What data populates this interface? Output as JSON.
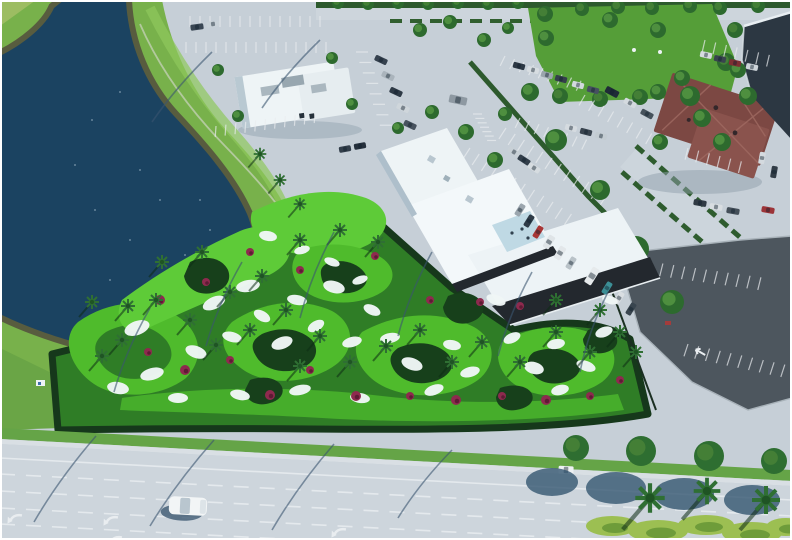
{
  "meta": {
    "title": "aerial-photo-mini-golf-complex",
    "width": 792,
    "height": 540
  },
  "palette": {
    "pavement": "#c6cfd7",
    "road": "#cdd5dc",
    "sidewalk": "#d9dfe4",
    "dark_lot": "#4d565e",
    "lake": "#1b4361",
    "rock_shore": "#585c3f",
    "bank_grass": "#78b14b",
    "bank_light": "#8fc75d",
    "verge_grass": "#65a447",
    "golf_base": "#2f7d26",
    "golf_bright": "#4fbb2c",
    "golf_light": "#5ecb38",
    "shrub_dark": "#17401b",
    "bunker": "#f0f6f6",
    "roof_white": "#eef4f6",
    "wall_dark": "#23282e",
    "roof_red": "#7c4843",
    "roof_red_light": "#8a534d",
    "dark_building": "#2c3742",
    "hedge": "#2d5a2d",
    "tree": "#2e6e31",
    "shadow_blue": "#31536e",
    "line_white": "#e9edf0",
    "flower": "#8e2a4e",
    "patio_blue": "#bfd9e4",
    "field_grass": "#559e38"
  },
  "scene": {
    "regions": [
      "lake",
      "mini-golf-course",
      "clubhouse",
      "north-building",
      "red-roof-building",
      "parking-lots",
      "boulevard"
    ],
    "cars": [
      [
        197,
        27,
        13,
        6,
        -8,
        "#3a4754"
      ],
      [
        213,
        24,
        13,
        6,
        -8,
        "#c9d2d8"
      ],
      [
        381,
        60,
        13,
        6,
        25,
        "#35414e"
      ],
      [
        388,
        76,
        13,
        6,
        25,
        "#aab4bc"
      ],
      [
        396,
        92,
        13,
        6,
        25,
        "#2e3a46"
      ],
      [
        403,
        108,
        13,
        6,
        25,
        "#cfd6db"
      ],
      [
        410,
        125,
        13,
        6,
        25,
        "#47525e"
      ],
      [
        458,
        100,
        18,
        8,
        12,
        "#8e99a2"
      ],
      [
        345,
        149,
        12,
        6,
        -10,
        "#323e4a"
      ],
      [
        360,
        146,
        12,
        6,
        -10,
        "#25303c"
      ],
      [
        519,
        66,
        12,
        6,
        15,
        "#2c3844"
      ],
      [
        533,
        70,
        12,
        6,
        15,
        "#d7dde1"
      ],
      [
        547,
        75,
        12,
        6,
        15,
        "#9aa5ad"
      ],
      [
        561,
        79,
        12,
        6,
        15,
        "#343f4b"
      ],
      [
        578,
        85,
        12,
        6,
        15,
        "#d2d9de"
      ],
      [
        593,
        90,
        12,
        6,
        15,
        "#465160"
      ],
      [
        571,
        128,
        12,
        6,
        15,
        "#d5dbe0"
      ],
      [
        586,
        132,
        12,
        6,
        15,
        "#39444f"
      ],
      [
        601,
        136,
        12,
        6,
        15,
        "#c3ccd2"
      ],
      [
        514,
        152,
        13,
        6,
        33,
        "#c8d0d6"
      ],
      [
        524,
        160,
        13,
        6,
        33,
        "#323e4a"
      ],
      [
        534,
        168,
        13,
        6,
        33,
        "#d6dce0"
      ],
      [
        520,
        210,
        13,
        6,
        -58,
        "#9ba6ae"
      ],
      [
        529,
        221,
        13,
        6,
        -58,
        "#2f3b47"
      ],
      [
        538,
        232,
        13,
        6,
        -58,
        "#a83636"
      ],
      [
        549,
        242,
        14,
        7,
        -58,
        "#dfe4e7"
      ],
      [
        560,
        253,
        14,
        7,
        -58,
        "#e3e7ea"
      ],
      [
        571,
        263,
        13,
        6,
        -58,
        "#b9c2c8"
      ],
      [
        592,
        276,
        18,
        8,
        -58,
        "#e6eaec"
      ],
      [
        607,
        288,
        13,
        6,
        -58,
        "#3c8f96"
      ],
      [
        619,
        298,
        13,
        6,
        -58,
        "#d9dee2"
      ],
      [
        631,
        309,
        13,
        6,
        -58,
        "#39454f"
      ],
      [
        612,
        92,
        14,
        7,
        28,
        "#1f2b37"
      ],
      [
        630,
        103,
        13,
        6,
        28,
        "#d4dadf"
      ],
      [
        647,
        114,
        13,
        6,
        28,
        "#46525c"
      ],
      [
        706,
        55,
        12,
        6,
        12,
        "#d6dce0"
      ],
      [
        720,
        59,
        12,
        6,
        12,
        "#39444e"
      ],
      [
        735,
        63,
        12,
        6,
        12,
        "#7e2f33"
      ],
      [
        752,
        67,
        12,
        6,
        12,
        "#cdd4d9"
      ],
      [
        700,
        203,
        13,
        6,
        10,
        "#2f3a44"
      ],
      [
        716,
        207,
        13,
        6,
        10,
        "#d8dde1"
      ],
      [
        733,
        211,
        13,
        6,
        10,
        "#444f59"
      ],
      [
        768,
        210,
        13,
        6,
        10,
        "#9c3438"
      ],
      [
        762,
        158,
        12,
        6,
        100,
        "#d4dadf"
      ],
      [
        774,
        172,
        12,
        6,
        100,
        "#313c46"
      ],
      [
        566,
        470,
        15,
        8,
        3,
        "#eef1f3"
      ]
    ],
    "parking_rows": [
      [
        190,
        16,
        0,
        14,
        10,
        11,
        0
      ],
      [
        186,
        42,
        0,
        15,
        10,
        11,
        0
      ],
      [
        216,
        126,
        -8,
        11,
        10,
        11,
        12
      ],
      [
        368,
        52,
        72,
        8,
        11,
        12,
        18
      ],
      [
        505,
        56,
        18,
        9,
        10,
        11,
        8
      ],
      [
        520,
        118,
        18,
        8,
        10,
        11,
        8
      ],
      [
        470,
        148,
        33,
        12,
        11,
        13,
        0
      ],
      [
        506,
        128,
        33,
        12,
        11,
        13,
        0
      ],
      [
        585,
        95,
        30,
        8,
        11,
        12,
        0
      ],
      [
        688,
        148,
        14,
        6,
        11,
        12,
        0
      ],
      [
        705,
        40,
        13,
        7,
        11,
        12,
        0
      ],
      [
        652,
        262,
        8,
        11,
        11,
        13,
        6
      ],
      [
        688,
        344,
        12,
        10,
        11,
        13,
        6
      ],
      [
        482,
        114,
        62,
        7,
        5,
        9,
        28
      ]
    ],
    "bunkers": [
      [
        137,
        328,
        13,
        7,
        -20
      ],
      [
        118,
        388,
        11,
        6,
        10
      ],
      [
        152,
        374,
        12,
        6,
        -15
      ],
      [
        178,
        398,
        10,
        5,
        0
      ],
      [
        196,
        352,
        11,
        6,
        20
      ],
      [
        214,
        303,
        12,
        6,
        -25
      ],
      [
        232,
        337,
        10,
        5,
        15
      ],
      [
        248,
        286,
        12,
        6,
        -10
      ],
      [
        262,
        316,
        9,
        5,
        30
      ],
      [
        282,
        343,
        11,
        6,
        -20
      ],
      [
        297,
        300,
        10,
        5,
        10
      ],
      [
        316,
        326,
        9,
        5,
        -30
      ],
      [
        334,
        287,
        11,
        6,
        15
      ],
      [
        352,
        342,
        10,
        5,
        -15
      ],
      [
        372,
        310,
        9,
        5,
        25
      ],
      [
        390,
        338,
        10,
        5,
        -10
      ],
      [
        412,
        364,
        11,
        6,
        20
      ],
      [
        434,
        390,
        10,
        5,
        -20
      ],
      [
        452,
        345,
        9,
        5,
        10
      ],
      [
        470,
        372,
        10,
        5,
        -15
      ],
      [
        496,
        300,
        10,
        5,
        20
      ],
      [
        512,
        338,
        9,
        5,
        -25
      ],
      [
        534,
        368,
        10,
        6,
        15
      ],
      [
        556,
        344,
        9,
        5,
        -10
      ],
      [
        586,
        366,
        10,
        5,
        20
      ],
      [
        604,
        332,
        9,
        5,
        -20
      ],
      [
        268,
        236,
        9,
        5,
        10
      ],
      [
        302,
        250,
        8,
        4,
        -15
      ],
      [
        332,
        262,
        8,
        4,
        20
      ],
      [
        360,
        280,
        8,
        4,
        -20
      ],
      [
        240,
        395,
        10,
        5,
        12
      ],
      [
        300,
        390,
        11,
        5,
        -12
      ],
      [
        360,
        398,
        10,
        5,
        8
      ],
      [
        560,
        390,
        9,
        5,
        -14
      ],
      [
        610,
        300,
        8,
        4,
        16
      ]
    ],
    "flowers": [
      [
        160,
        300,
        5
      ],
      [
        185,
        370,
        5
      ],
      [
        230,
        360,
        4
      ],
      [
        270,
        395,
        5
      ],
      [
        310,
        370,
        4
      ],
      [
        356,
        396,
        5
      ],
      [
        410,
        396,
        4
      ],
      [
        456,
        400,
        5
      ],
      [
        300,
        270,
        4
      ],
      [
        250,
        252,
        4
      ],
      [
        502,
        396,
        4
      ],
      [
        546,
        400,
        5
      ],
      [
        480,
        302,
        4
      ],
      [
        430,
        300,
        4
      ],
      [
        375,
        256,
        4
      ],
      [
        590,
        396,
        4
      ],
      [
        620,
        380,
        4
      ],
      [
        206,
        282,
        4
      ],
      [
        148,
        352,
        4
      ],
      [
        520,
        306,
        4
      ]
    ],
    "palms": [
      [
        92,
        302,
        1
      ],
      [
        122,
        340,
        1
      ],
      [
        156,
        300,
        1
      ],
      [
        190,
        320,
        1
      ],
      [
        216,
        345,
        1
      ],
      [
        250,
        330,
        1
      ],
      [
        286,
        310,
        1
      ],
      [
        320,
        336,
        1
      ],
      [
        300,
        366,
        1
      ],
      [
        350,
        362,
        1
      ],
      [
        386,
        346,
        1
      ],
      [
        420,
        330,
        1
      ],
      [
        452,
        362,
        1
      ],
      [
        482,
        342,
        1
      ],
      [
        520,
        362,
        1
      ],
      [
        556,
        332,
        1
      ],
      [
        590,
        352,
        1
      ],
      [
        620,
        332,
        1
      ],
      [
        262,
        276,
        1
      ],
      [
        300,
        240,
        1
      ],
      [
        340,
        230,
        1
      ],
      [
        378,
        242,
        1
      ],
      [
        202,
        252,
        1
      ],
      [
        162,
        262,
        1
      ],
      [
        230,
        292,
        1
      ],
      [
        128,
        306,
        1
      ],
      [
        102,
        356,
        1
      ],
      [
        556,
        300,
        1
      ],
      [
        600,
        310,
        1
      ],
      [
        636,
        352,
        1
      ],
      [
        260,
        154,
        0.9
      ],
      [
        280,
        180,
        0.9
      ],
      [
        300,
        204,
        0.9
      ]
    ],
    "foreground_palms": [
      [
        650,
        498,
        2.1
      ],
      [
        707,
        491,
        1.9
      ],
      [
        766,
        500,
        2.0
      ]
    ],
    "parking_trees": [
      [
        530,
        92,
        9
      ],
      [
        556,
        140,
        11
      ],
      [
        600,
        190,
        10
      ],
      [
        636,
        249,
        13
      ],
      [
        672,
        302,
        12
      ],
      [
        505,
        114,
        7
      ],
      [
        546,
        38,
        8
      ],
      [
        610,
        20,
        8
      ],
      [
        658,
        30,
        8
      ],
      [
        690,
        96,
        10
      ],
      [
        722,
        142,
        9
      ],
      [
        748,
        96,
        9
      ],
      [
        238,
        116,
        6
      ],
      [
        218,
        70,
        6
      ],
      [
        332,
        58,
        6
      ],
      [
        352,
        104,
        6
      ],
      [
        658,
        92,
        8
      ],
      [
        682,
        78,
        8
      ],
      [
        702,
        118,
        9
      ],
      [
        738,
        70,
        8
      ],
      [
        660,
        142,
        8
      ],
      [
        420,
        30,
        7
      ],
      [
        450,
        22,
        7
      ],
      [
        484,
        40,
        7
      ],
      [
        508,
        28,
        6
      ],
      [
        432,
        112,
        7
      ],
      [
        466,
        132,
        8
      ],
      [
        495,
        160,
        8
      ],
      [
        420,
        155,
        7
      ],
      [
        398,
        128,
        6
      ]
    ],
    "field_trees": [
      [
        545,
        14,
        8
      ],
      [
        582,
        9,
        7
      ],
      [
        618,
        7,
        7
      ],
      [
        652,
        8,
        7
      ],
      [
        560,
        96,
        8
      ],
      [
        600,
        99,
        8
      ],
      [
        640,
        97,
        8
      ],
      [
        700,
        92,
        9
      ],
      [
        726,
        62,
        9
      ],
      [
        735,
        30,
        8
      ],
      [
        338,
        3,
        6
      ],
      [
        368,
        4,
        6
      ],
      [
        398,
        3,
        6
      ],
      [
        428,
        4,
        6
      ],
      [
        458,
        3,
        6
      ],
      [
        488,
        4,
        6
      ],
      [
        518,
        3,
        6
      ],
      [
        690,
        6,
        7
      ],
      [
        720,
        8,
        7
      ],
      [
        758,
        6,
        7
      ]
    ],
    "field_dots": [
      [
        634,
        50
      ],
      [
        660,
        52
      ]
    ],
    "verge_trees": [
      [
        576,
        448,
        13
      ],
      [
        641,
        451,
        15
      ],
      [
        709,
        456,
        15
      ],
      [
        774,
        461,
        13
      ]
    ],
    "tree_shadows": [
      [
        552,
        482,
        26,
        14
      ],
      [
        616,
        488,
        30,
        16
      ],
      [
        684,
        494,
        30,
        16
      ],
      [
        752,
        500,
        28,
        15
      ]
    ],
    "hedge_blobs": [
      [
        612,
        526,
        26,
        10
      ],
      [
        658,
        531,
        30,
        11
      ],
      [
        706,
        525,
        28,
        10
      ],
      [
        752,
        533,
        30,
        11
      ],
      [
        786,
        527,
        20,
        9
      ]
    ],
    "pole_shadows": [
      [
        96,
        436,
        34,
        522
      ],
      [
        214,
        440,
        150,
        526
      ],
      [
        334,
        444,
        272,
        530
      ],
      [
        452,
        450,
        398,
        518
      ],
      [
        150,
        308,
        114,
        392
      ],
      [
        242,
        262,
        206,
        346
      ],
      [
        334,
        232,
        300,
        318
      ],
      [
        432,
        252,
        398,
        336
      ],
      [
        532,
        272,
        498,
        356
      ],
      [
        608,
        292,
        580,
        372
      ],
      [
        212,
        52,
        152,
        122
      ],
      [
        320,
        40,
        262,
        108
      ]
    ],
    "lane_lines": [
      [
        458,
        0
      ],
      [
        474,
        1
      ],
      [
        491,
        1
      ],
      [
        508,
        1
      ],
      [
        524,
        1
      ]
    ],
    "turn_arrows": [
      [
        14,
        514
      ],
      [
        110,
        516
      ],
      [
        338,
        528
      ],
      [
        706,
        522
      ],
      [
        114,
        536
      ]
    ],
    "lot_arrows": [
      [
        668,
        300,
        -60
      ],
      [
        700,
        352,
        -60
      ]
    ],
    "sparkles": [
      [
        95,
        210
      ],
      [
        130,
        240
      ],
      [
        160,
        200
      ],
      [
        110,
        280
      ],
      [
        185,
        255
      ],
      [
        75,
        165
      ],
      [
        150,
        300
      ],
      [
        210,
        230
      ],
      [
        92,
        120
      ],
      [
        120,
        92
      ],
      [
        140,
        170
      ],
      [
        200,
        200
      ]
    ]
  }
}
